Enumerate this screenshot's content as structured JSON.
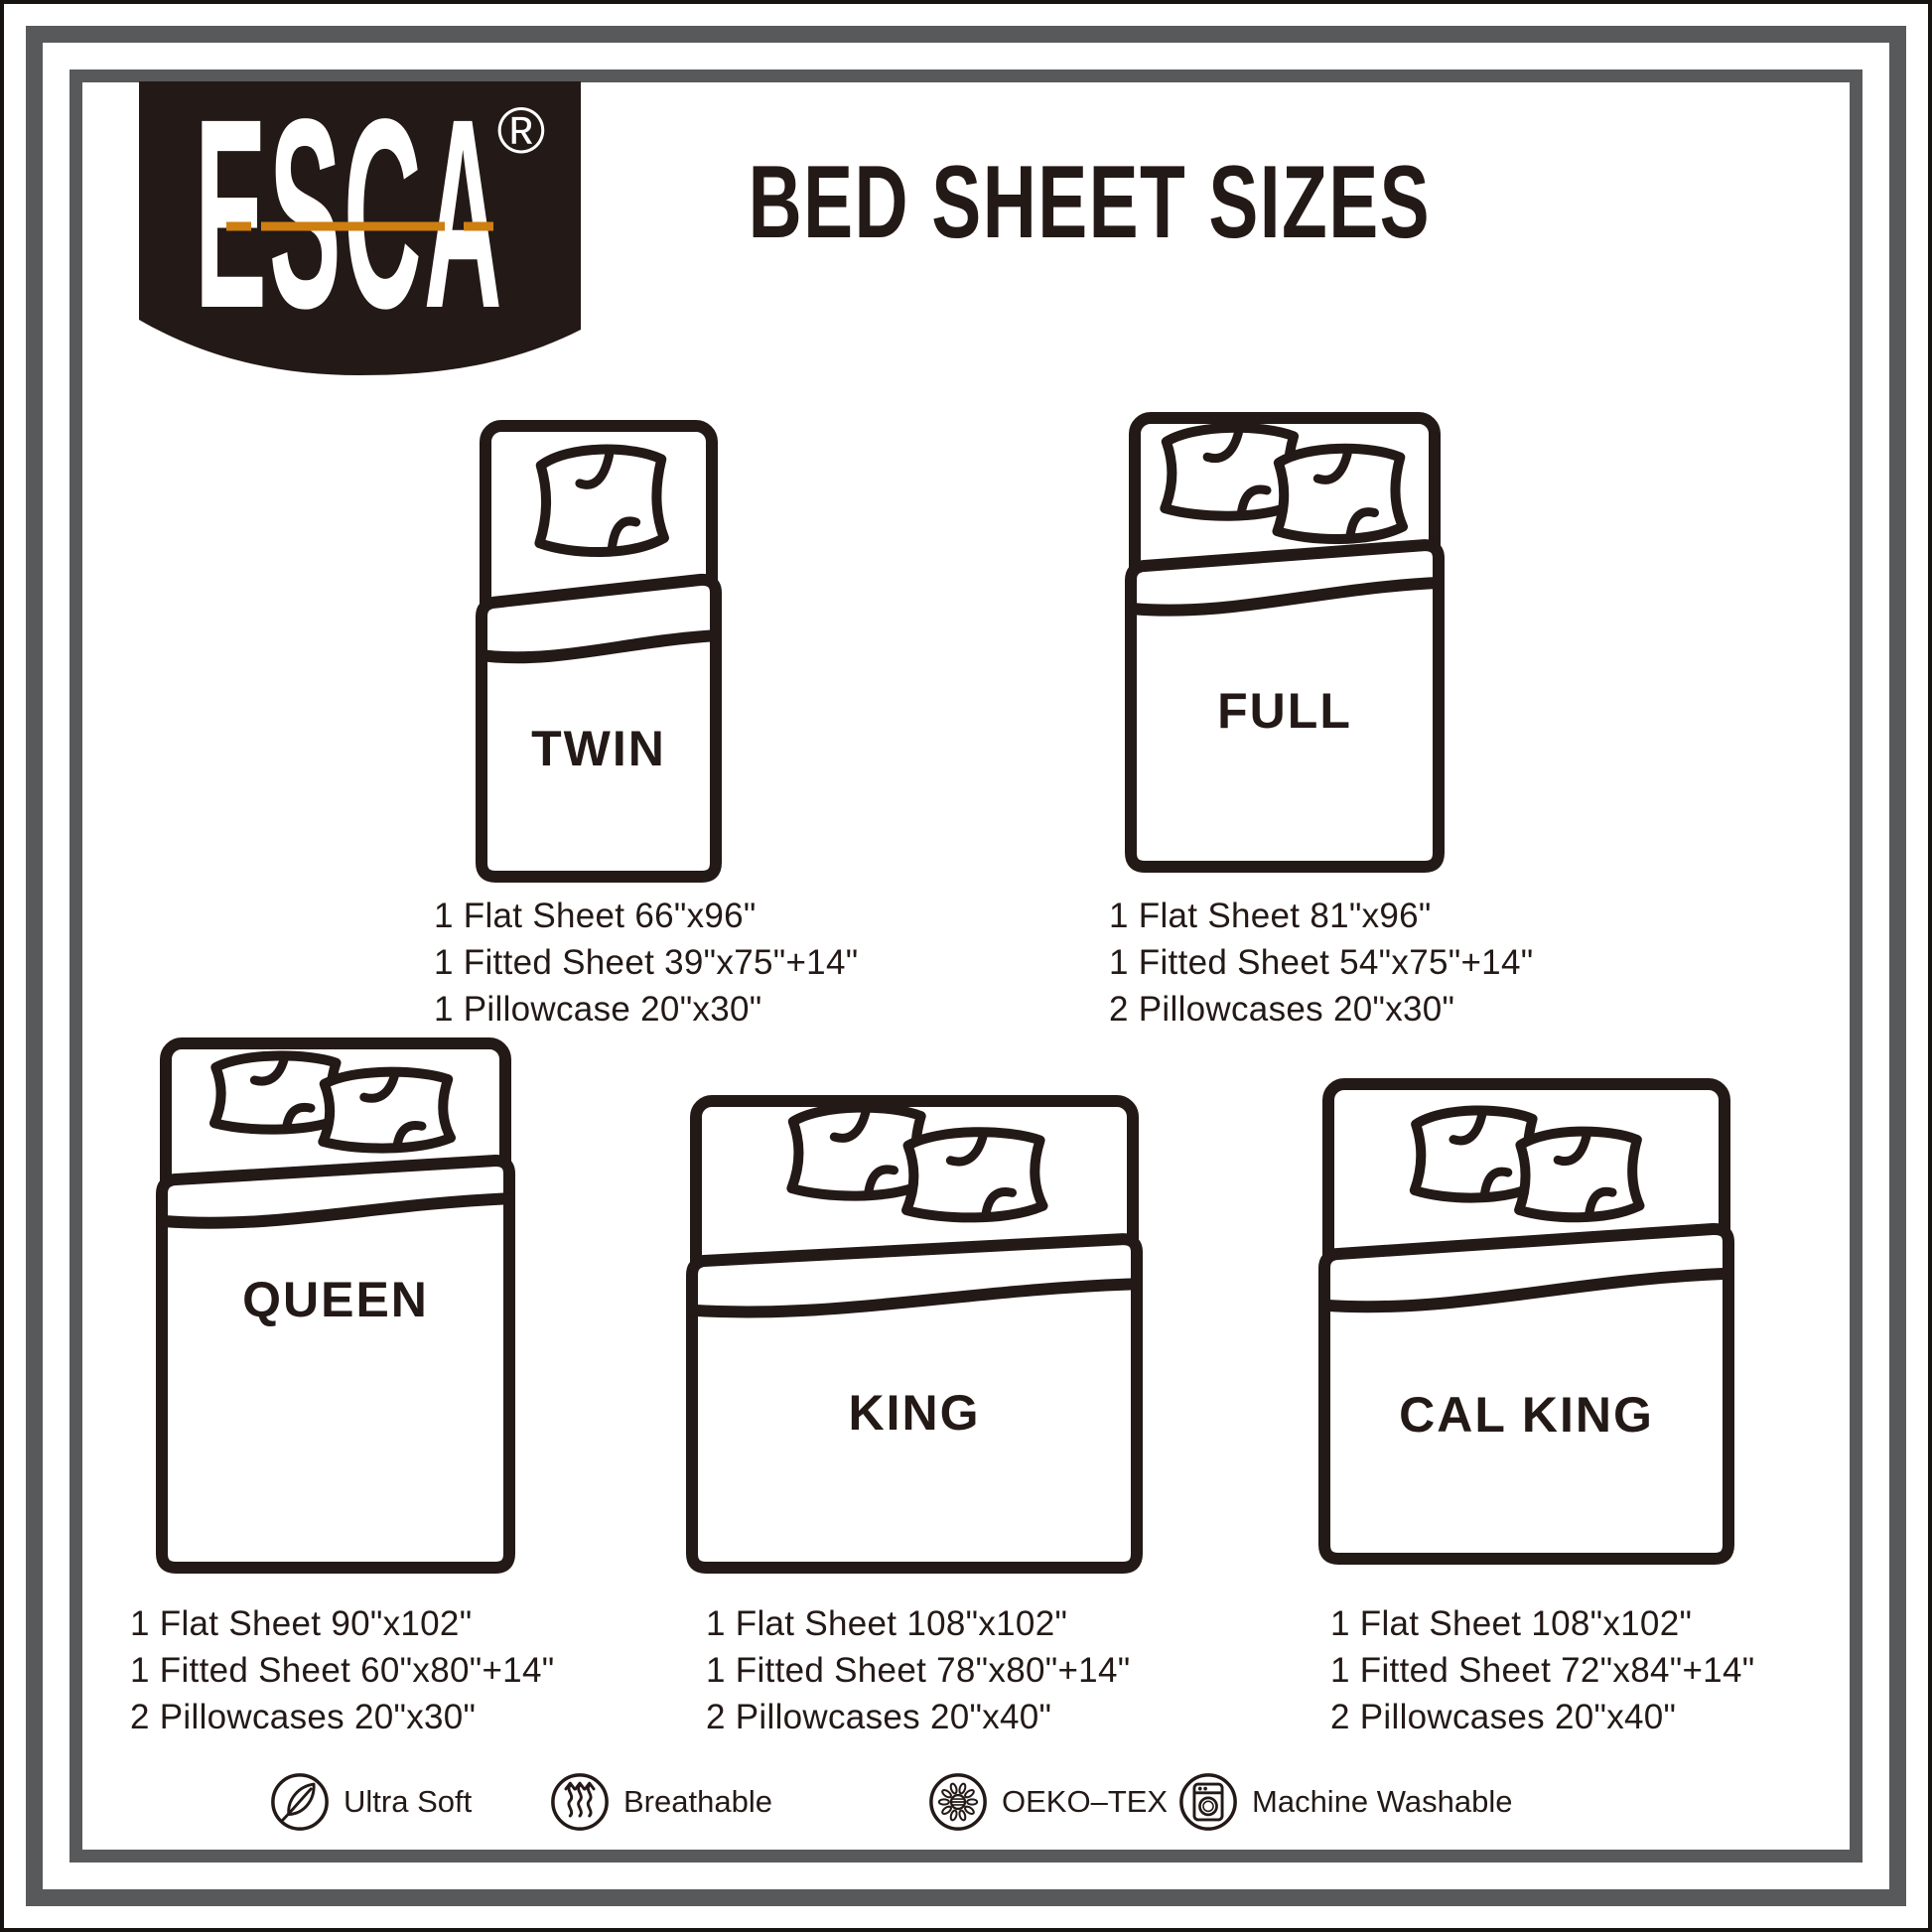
{
  "brand": {
    "name": "ESCA",
    "registered": "®"
  },
  "title": "BED SHEET SIZES",
  "sizes": [
    {
      "id": "twin",
      "label": "TWIN",
      "pillows": 1,
      "specs": [
        "1 Flat Sheet 66\"x96\"",
        "1 Fitted Sheet 39\"x75\"+14\"",
        "1 Pillowcase 20\"x30\""
      ]
    },
    {
      "id": "full",
      "label": "FULL",
      "pillows": 2,
      "specs": [
        "1 Flat Sheet 81\"x96\"",
        "1 Fitted Sheet 54\"x75\"+14\"",
        "2 Pillowcases 20\"x30\""
      ]
    },
    {
      "id": "queen",
      "label": "QUEEN",
      "pillows": 2,
      "specs": [
        "1 Flat Sheet 90\"x102\"",
        "1 Fitted Sheet 60\"x80\"+14\"",
        "2 Pillowcases 20\"x30\""
      ]
    },
    {
      "id": "king",
      "label": "KING",
      "pillows": 2,
      "specs": [
        "1 Flat Sheet 108\"x102\"",
        "1 Fitted Sheet 78\"x80\"+14\"",
        "2 Pillowcases 20\"x40\""
      ]
    },
    {
      "id": "cal_king",
      "label": "CAL KING",
      "pillows": 2,
      "specs": [
        "1 Flat Sheet 108\"x102\"",
        "1 Fitted Sheet 72\"x84\"+14\"",
        "2 Pillowcases 20\"x40\""
      ]
    }
  ],
  "features": [
    {
      "icon": "feather-icon",
      "label": "Ultra Soft"
    },
    {
      "icon": "air-waves-icon",
      "label": "Breathable"
    },
    {
      "icon": "oeko-tex-icon",
      "label": "OEKO–TEX"
    },
    {
      "icon": "washing-machine-icon",
      "label": "Machine Washable"
    }
  ],
  "colors": {
    "ink": "#231916",
    "frame_gray": "#58595b",
    "logo_accent_orange": "#ce7f10"
  }
}
